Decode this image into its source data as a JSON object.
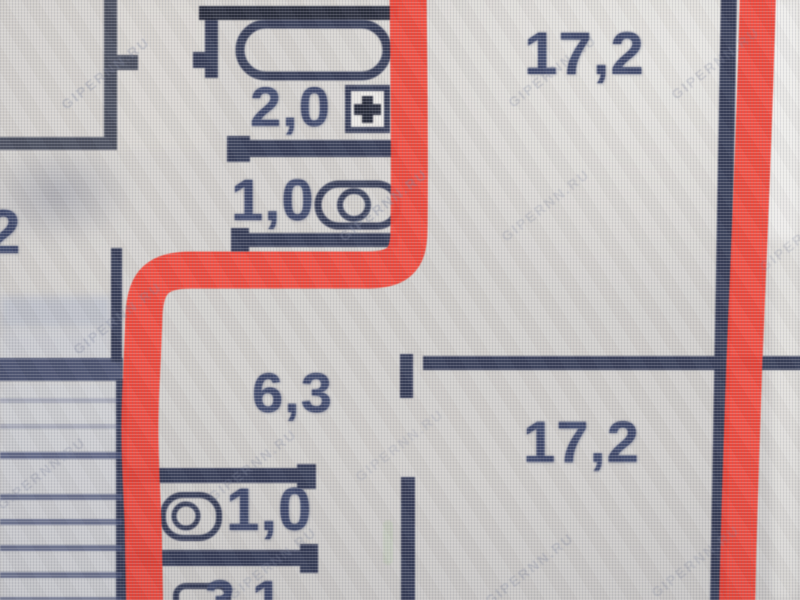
{
  "colors": {
    "marker": "#ee3426",
    "wall": "#262d49",
    "wall_dark": "#171b2c",
    "wall_gray": "#3a3f50",
    "label_text": "#303a5e",
    "background": "#d1cec9"
  },
  "labels": {
    "room_left": "2",
    "bathroom_top": "2,0",
    "wc_top": "1,0",
    "room_top_right": "17,2",
    "hallway": "6,3",
    "room_bottom_right": "17,2",
    "wc_bottom": "1,0",
    "corridor_bottom": "3,1"
  },
  "watermark": {
    "text": "GIPERNN.RU"
  },
  "icons": {
    "bathtub": "bathtub-icon",
    "vent": "vent-plus-icon",
    "toilet_top": "toilet-icon",
    "toilet_bottom": "toilet-icon",
    "sink": "sink-icon"
  }
}
